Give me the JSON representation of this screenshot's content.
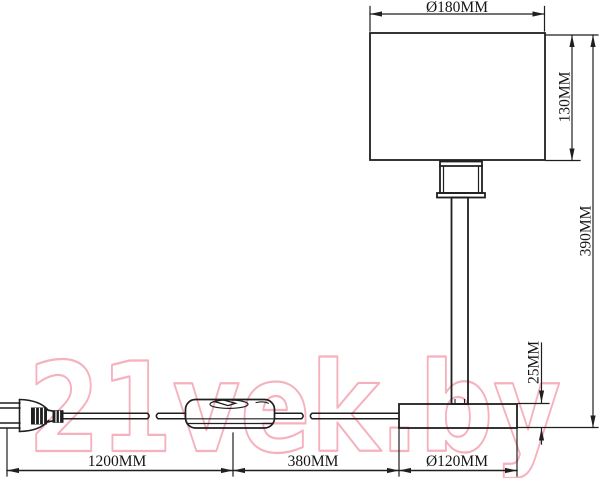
{
  "watermark": {
    "text": "21vek.by",
    "stroke_color": "#f5adbc"
  },
  "dimensions": {
    "shade_diameter": "Ø180MM",
    "shade_height": "130MM",
    "total_height": "390MM",
    "base_height": "25MM",
    "cord_length": "1200MM",
    "switch_to_base": "380MM",
    "base_diameter": "Ø120MM"
  },
  "colors": {
    "line": "#1f1f1f",
    "background": "#ffffff",
    "watermark": "#f5adbc"
  },
  "components": {
    "shade": "lamp shade",
    "socket": "lamp socket",
    "pole": "lamp pole",
    "base": "lamp base",
    "cord": "power cord",
    "switch": "inline rocker switch",
    "plug": "power plug"
  }
}
